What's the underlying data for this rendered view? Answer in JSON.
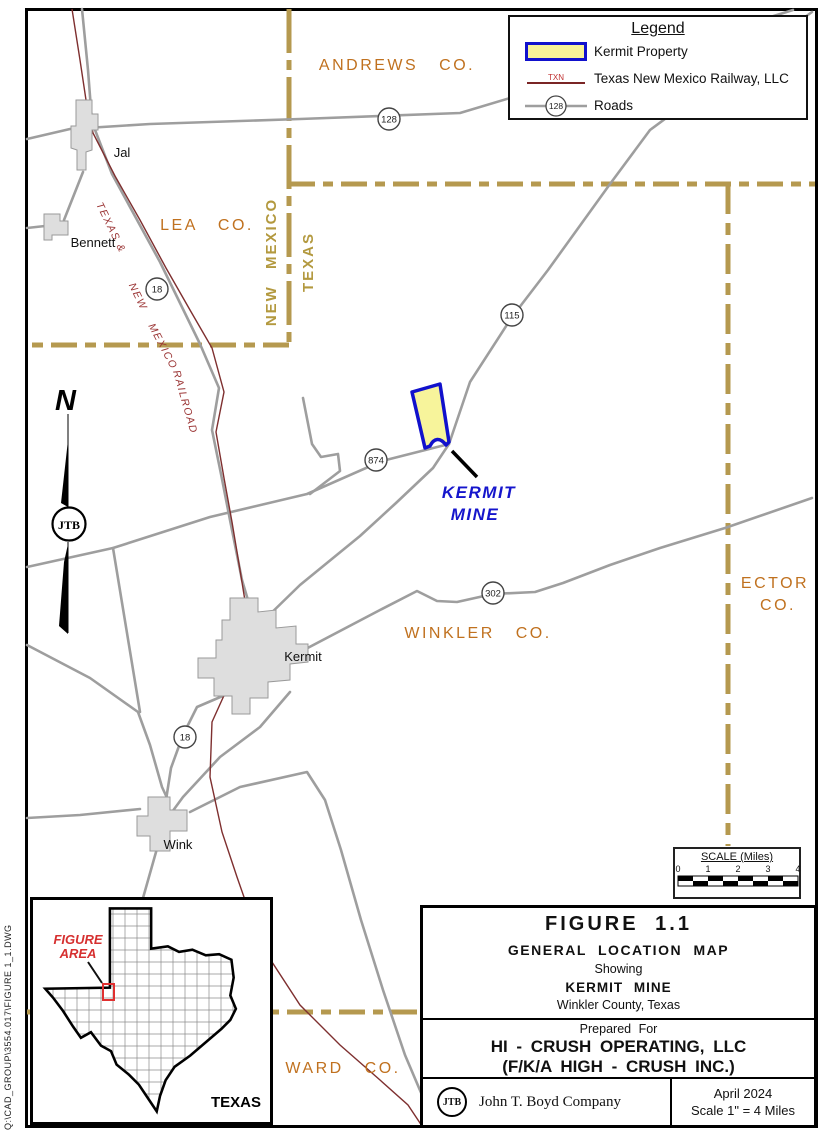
{
  "file_note": "Q:\\CAD_GROUP\\3554.017\\FIGURE 1_1.DWG",
  "north_label": "N",
  "legend": {
    "title": "Legend",
    "kermit_property": "Kermit Property",
    "railway_abbr": "TXN",
    "railway": "Texas New Mexico Railway, LLC",
    "roads_shield": "128",
    "roads": "Roads"
  },
  "map": {
    "counties": {
      "andrews": "ANDREWS CO.",
      "lea": "LEA CO.",
      "winkler": "WINKLER CO.",
      "ector_line1": "ECTOR",
      "ector_line2": "CO.",
      "ward": "WARD CO."
    },
    "states": {
      "new_mexico": "NEW MEXICO",
      "texas": "TEXAS"
    },
    "towns": {
      "jal": "Jal",
      "bennett": "Bennett",
      "kermit": "Kermit",
      "wink": "Wink"
    },
    "shields": {
      "s128": "128",
      "s18n": "18",
      "s115": "115",
      "s874": "874",
      "s302": "302",
      "s18s": "18"
    },
    "railroad": {
      "l1": "TEXAS &",
      "l2": "NEW",
      "l3": "MEXICO",
      "l4": "RAILROAD"
    },
    "mine": {
      "line1": "KERMIT",
      "line2": "MINE"
    },
    "logo": "JTB"
  },
  "scale_bar": {
    "title": "SCALE (Miles)",
    "t0": "0",
    "t1": "1",
    "t2": "2",
    "t3": "3",
    "t4": "4"
  },
  "inset": {
    "figure_area_line1": "FIGURE",
    "figure_area_line2": "AREA",
    "state": "TEXAS"
  },
  "title_block": {
    "figure": "FIGURE 1.1",
    "subtitle": "GENERAL LOCATION MAP",
    "showing": "Showing",
    "mine": "KERMIT MINE",
    "county": "Winkler County, Texas",
    "prepared_for": "Prepared For",
    "company_line1": "HI - CRUSH OPERATING, LLC",
    "company_line2": "(F/K/A HIGH - CRUSH INC.)",
    "logo": "JTB",
    "author": "John T. Boyd Company",
    "date": "April 2024",
    "map_scale": "Scale 1\" =  4  Miles"
  },
  "colors": {
    "boundary_tan": "#B5994F",
    "county_text": "#C0711F",
    "state_text": "#B3993F",
    "road_gray": "#9E9E9E",
    "railroad_maroon": "#7E2F2F",
    "property_fill": "#F7F49B",
    "property_border": "#1111CC",
    "mine_text": "#1515CC"
  }
}
